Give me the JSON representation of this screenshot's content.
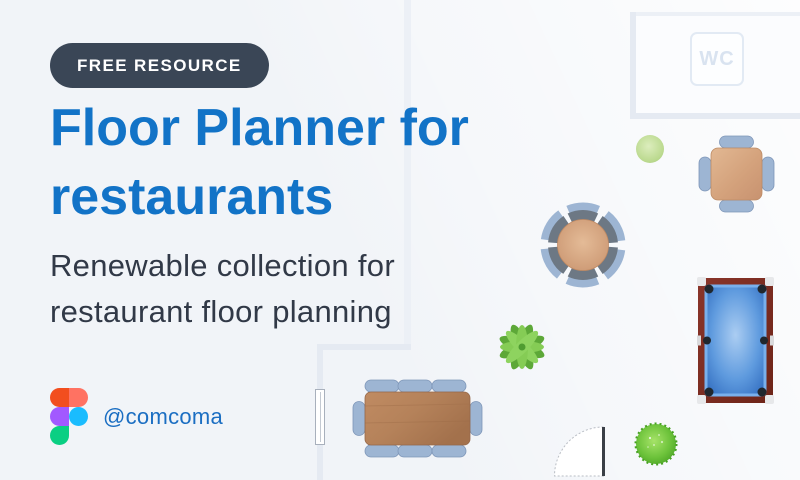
{
  "page": {
    "background": "#f1f4f8",
    "accent_blue": "#1273c7"
  },
  "hero": {
    "badge": {
      "label": "FREE RESOURCE",
      "bg": "#3a4656",
      "text_color": "#ffffff"
    },
    "title_line1": "Floor Planner for",
    "title_line2": "restaurants",
    "title_color": "#1273c7",
    "subtitle_line1": "Renewable collection for",
    "subtitle_line2": "restaurant floor planning",
    "subtitle_color": "#313947"
  },
  "attribution": {
    "handle": "@comcoma",
    "handle_color": "#1b6ec2",
    "logo_icon": "figma-logo-icon",
    "figma_colors": {
      "red": "#f24e1e",
      "salmon": "#ff7262",
      "purple": "#a259ff",
      "blue": "#1abcfe",
      "green": "#0acf83"
    }
  },
  "floor_plan": {
    "wc_label": "WC",
    "wall_color": "#e5eaf2",
    "items": [
      {
        "name": "wc-room"
      },
      {
        "name": "square-table-4-chairs"
      },
      {
        "name": "round-table-6-chairs"
      },
      {
        "name": "rect-table-8-chairs"
      },
      {
        "name": "pool-table"
      },
      {
        "name": "door-swing"
      },
      {
        "name": "window-marker"
      },
      {
        "name": "palm-plant"
      },
      {
        "name": "bush-small"
      },
      {
        "name": "bush-large"
      }
    ],
    "colors": {
      "wood_light": "#d7a985",
      "wood_dark": "#b5825c",
      "chair_seat": "#9db5d3",
      "chair_back": "#76828e",
      "pool_frame": "#7b2c20",
      "pool_felt": "#2f6fc4",
      "plant_green": "#6fbb45",
      "bush_green": "#4aa324"
    }
  }
}
